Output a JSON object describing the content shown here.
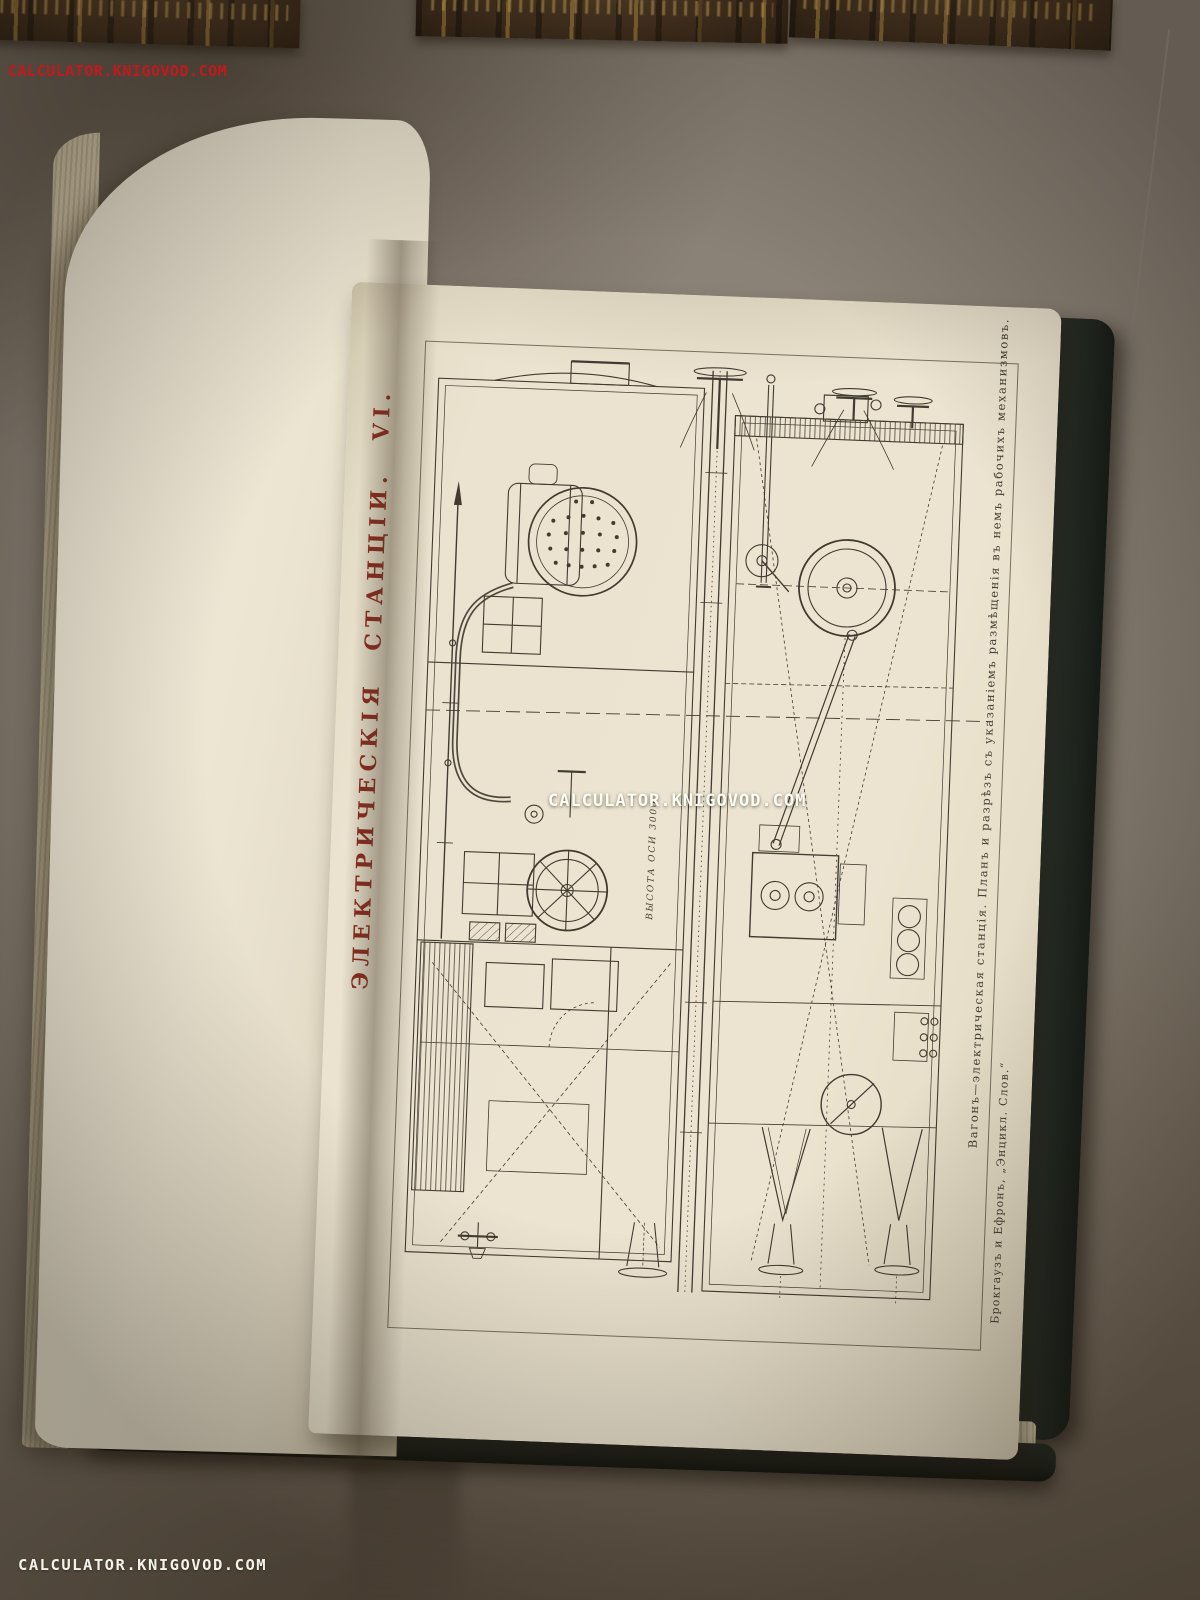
{
  "photo": {
    "description": "open antique encyclopedia volume with engraved plate, three gilt book spines at top of table",
    "watermarks": {
      "top_left": "CALCULATOR.KNIGOVOD.COM",
      "center": "CALCULATOR.KNIGOVOD.COM",
      "bottom_left": "CALCULATOR.KNIGOVOD.COM"
    },
    "colors": {
      "table": "#877e72",
      "page_cream": "#ece4d0",
      "engraving_line": "#413b31",
      "title_red": "#8c2a1e",
      "cover_green": "#232a23",
      "watermark_red": "#c2191d",
      "watermark_white": "#fdfdf6"
    }
  },
  "plate": {
    "title_vertical": "ЭЛЕКТРИЧЕСКІЯ СТАНЦІИ. VI.",
    "caption_main": "Вагонъ—электрическая станція. Планъ и разрѣзъ съ указаніемъ размѣщенія въ немъ рабочихъ механизмовъ.",
    "caption_source": "Брокгаузъ и Ефронъ, „Энцикл. Слов.“",
    "axis_height_label": "ВЫСОТА ОСИ 3000"
  }
}
